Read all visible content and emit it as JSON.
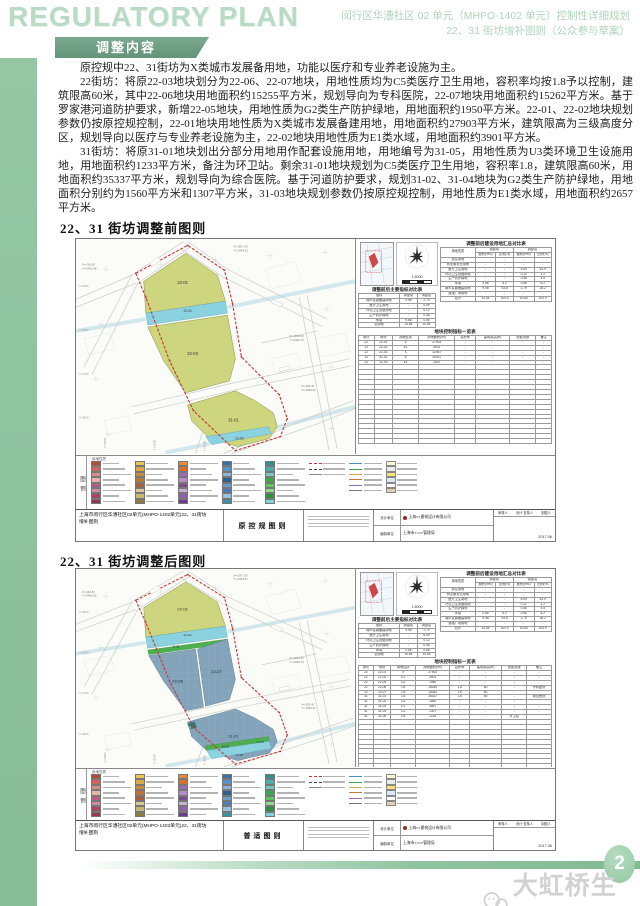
{
  "header": {
    "title_en": "REGULATORY PLAN",
    "doc_title_line1": "闵行区华漕社区 02 单元（MHPO-1402 单元）控制性详细规划",
    "doc_title_line2": "22、31 街坊增补图则（公众参与草案）",
    "section_banner": "调整内容"
  },
  "body": {
    "para1": "原控规中22、31街坊为X类城市发展备用地，功能以医疗和专业养老设施为主。",
    "para2": "22街坊：将原22-03地块划分为22-06、22-07地块，用地性质均为C5类医疗卫生用地，容积率均按1.8予以控制，建筑限高60米，其中22-06地块用地面积约15255平方米，规划导向为专科医院，22-07地块用地面积约15262平方米。基于罗家港河道防护要求，新增22-05地块，用地性质为G2类生产防护绿地，用地面积约1950平方米。22-01、22-02地块规划参数仍按原控规控制，22-01地块用地性质为X类城市发展备建用地，用地面积约27903平方米，建筑限高为三级高度分区，规划导向以医疗与专业养老设施为主，22-02地块用地性质为E1类水域，用地面积约3901平方米。",
    "para3": "31街坊：将原31-01地块划出分部分用地用作配套设施用地，用地编号为31-05，用地性质为U3类环境卫生设施用地，用地面积约1233平方米，备注为环卫站。剩余31-01地块规划为C5类医疗卫生用地，容积率1.8，建筑限高60米，用地面积约35337平方米，规划导向为综合医院。基于河道防护要求，规划31-02、31-04地块为G2类生产防护绿地，用地面积分别约为1560平方米和1307平方米，31-03地块规划参数仍按原控规控制，用地性质为E1类水域，用地面积约2657平方米。"
  },
  "sections": {
    "before_heading": "22、31 街坊调整前图则",
    "after_heading": "22、31 街坊调整后图则"
  },
  "maps": {
    "before": {
      "sheet_label": "原控规图则",
      "parcels": {
        "a": "22-01",
        "b": "22-02",
        "c": "22-03",
        "d": "31-01",
        "e": "31-03"
      }
    },
    "after": {
      "sheet_label": "普适图则",
      "parcels": {
        "a": "22-01",
        "b": "22-02",
        "c": "22-05",
        "d": "22-06",
        "e": "22-07",
        "f": "31-01",
        "g": "31-02",
        "h": "31-03",
        "i": "31-04",
        "j": "31-05"
      }
    }
  },
  "map_annotations": {
    "scale": "1:5000",
    "x_labels": [
      "X-2500",
      "X-2600",
      "X-2700",
      "X-2800"
    ],
    "y_labels": [
      "Y-15800",
      "Y-16000",
      "Y-16200"
    ],
    "callouts": [
      [
        "X=-263.50",
        "Y=-2462.68"
      ],
      [
        "X=-297.170",
        "Y=-2443.81"
      ],
      [
        "X=-1863.50",
        "Y=-2440.76"
      ],
      [
        "X=-392.45",
        "Y=-2366.42"
      ]
    ]
  },
  "legend": {
    "tab": "图例",
    "header": "用地性质",
    "colors": [
      "#b5493f",
      "#c9685c",
      "#d98d82",
      "#e7b3a9",
      "#b75a80",
      "#cf8aa6",
      "#a8455f",
      "#8f3a52",
      "#e8c94e",
      "#d9a944",
      "#c98c3c",
      "#b8763c",
      "#a86136",
      "#d9c992",
      "#c9b671",
      "#8f7a3e",
      "#e88a3c",
      "#d96e30",
      "#9b6cb5",
      "#b58cc9",
      "#7c4c8f",
      "#c9b0d9",
      "#8f61a8",
      "#6e3c8f",
      "#3c70a8",
      "#5c90c9",
      "#90b4d9",
      "#2f618f",
      "#6e9cc9",
      "#4c7cb5",
      "#9cc1e0",
      "#3c90a8",
      "#2f908a",
      "#4cada8",
      "#70c9c0",
      "#3ca84c",
      "#5cc95c",
      "#90d990",
      "#2f8f3c",
      "#85d1df"
    ],
    "boundary_lines": [
      "#cc3333",
      "#444444",
      "#888888"
    ],
    "line_samples": [
      "#4a90c2",
      "#3aa84a",
      "#d9a944",
      "#cc7a3a",
      "#9b6ab5",
      "#777777"
    ],
    "misc_boxes": [
      "#fdf6d8",
      "#ececec",
      "#f5e27a",
      "#dce8f5",
      "#ffffff",
      "#e0d0b8"
    ]
  },
  "tables": {
    "before": {
      "summary": {
        "title": "调整前后建设用地汇总对比表",
        "header": [
          [
            [
              "用地性质",
              1,
              2
            ],
            [
              "调整前",
              2,
              1
            ],
            [
              "调整后",
              2,
              1
            ]
          ],
          [
            [
              "面积(hm²)",
              1,
              1
            ],
            [
              "比例(%)",
              1,
              1
            ],
            [
              "面积(hm²)",
              1,
              1
            ],
            [
              "比例(%)",
              1,
              1
            ]
          ]
        ],
        "rows": [
          [
            "居住用地",
            "-",
            "-",
            "-",
            "-"
          ],
          [
            "商业服务业用地",
            "-",
            "-",
            "-",
            "-"
          ],
          [
            "医疗卫生用地",
            "-",
            "-",
            "6.59",
            "61.9"
          ],
          [
            "环境卫生设施用地",
            "-",
            "-",
            "0.12",
            "1.2"
          ],
          [
            "生产防护绿地",
            "-",
            "-",
            "0.48",
            "4.5"
          ],
          [
            "水域",
            "0.66",
            "6.2",
            "0.66",
            "6.2"
          ],
          [
            "城市发展备建用地",
            "9.98",
            "93.8",
            "2.79",
            "26.2"
          ],
          [
            "道路广场用地",
            "-",
            "-",
            "-",
            "-"
          ],
          [
            "合计",
            "10.64",
            "100.0",
            "10.64",
            "100.0"
          ]
        ],
        "empty_rows": 0
      },
      "indicator": {
        "title": "调整前后主要指标对比表",
        "header": [
          [
            [
              "指标",
              1,
              1
            ],
            [
              "调整前",
              1,
              1
            ],
            [
              "调整后",
              1,
              1
            ]
          ]
        ],
        "rows": [
          [
            "城市发展备建用地",
            "9.98",
            "2.79"
          ],
          [
            "医疗卫生用地",
            "-",
            "6.59"
          ],
          [
            "环境卫生设施用地",
            "-",
            "0.12"
          ],
          [
            "生产防护绿地",
            "-",
            "0.48"
          ],
          [
            "水域",
            "0.66",
            "0.66"
          ],
          [
            "总用地",
            "10.64",
            "10.64"
          ]
        ],
        "empty_rows": 0
      },
      "control": {
        "title": "地块控制指标一览表",
        "header": [
          [
            [
              "街坊",
              1,
              1
            ],
            [
              "地块",
              1,
              1
            ],
            [
              "用地性质",
              1,
              1
            ],
            [
              "用地面积(m²)",
              1,
              1
            ],
            [
              "容积率",
              1,
              1
            ],
            [
              "建筑限高(m)",
              1,
              1
            ],
            [
              "配套设施",
              1,
              1
            ],
            [
              "备注",
              1,
              1
            ]
          ]
        ],
        "rows": [
          [
            "22",
            "22-01",
            "X",
            "27903",
            "-",
            "-",
            "-",
            "-"
          ],
          [
            "22",
            "22-02",
            "E1",
            "3901",
            "-",
            "-",
            "-",
            "-"
          ],
          [
            "22",
            "22-03",
            "X",
            "32467",
            "-",
            "-",
            "-",
            "-"
          ],
          [
            "31",
            "31-01",
            "X",
            "39437",
            "-",
            "-",
            "-",
            "-"
          ],
          [
            "31",
            "31-03",
            "E1",
            "2657",
            "-",
            "-",
            "-",
            "-"
          ]
        ],
        "empty_rows": 16
      }
    },
    "after": {
      "summary": {
        "title": "调整前后建设用地汇总对比表",
        "header": [
          [
            [
              "用地性质",
              1,
              2
            ],
            [
              "调整前",
              2,
              1
            ],
            [
              "调整后",
              2,
              1
            ]
          ],
          [
            [
              "面积(hm²)",
              1,
              1
            ],
            [
              "比例(%)",
              1,
              1
            ],
            [
              "面积(hm²)",
              1,
              1
            ],
            [
              "比例(%)",
              1,
              1
            ]
          ]
        ],
        "rows": [
          [
            "居住用地",
            "-",
            "-",
            "-",
            "-"
          ],
          [
            "商业服务业用地",
            "-",
            "-",
            "-",
            "-"
          ],
          [
            "医疗卫生用地",
            "-",
            "-",
            "6.59",
            "61.9"
          ],
          [
            "环境卫生设施用地",
            "-",
            "-",
            "0.12",
            "1.2"
          ],
          [
            "生产防护绿地",
            "-",
            "-",
            "0.48",
            "4.5"
          ],
          [
            "水域",
            "0.66",
            "6.2",
            "0.66",
            "6.2"
          ],
          [
            "城市发展备建用地",
            "9.98",
            "93.8",
            "2.79",
            "26.2"
          ],
          [
            "道路广场用地",
            "-",
            "-",
            "-",
            "-"
          ],
          [
            "合计",
            "10.64",
            "100.0",
            "10.64",
            "100.0"
          ]
        ],
        "empty_rows": 0
      },
      "indicator": {
        "title": "调整前后主要指标对比表",
        "header": [
          [
            [
              "指标",
              1,
              1
            ],
            [
              "调整前",
              1,
              1
            ],
            [
              "调整后",
              1,
              1
            ]
          ]
        ],
        "rows": [
          [
            "城市发展备建用地",
            "9.98",
            "2.79"
          ],
          [
            "医疗卫生用地",
            "-",
            "6.59"
          ],
          [
            "环境卫生设施用地",
            "-",
            "0.12"
          ],
          [
            "生产防护绿地",
            "-",
            "0.48"
          ],
          [
            "水域",
            "0.66",
            "0.66"
          ],
          [
            "总用地",
            "10.64",
            "10.64"
          ]
        ],
        "empty_rows": 0
      },
      "control": {
        "title": "地块控制指标一览表",
        "header": [
          [
            [
              "街坊",
              1,
              1
            ],
            [
              "地块",
              1,
              1
            ],
            [
              "用地性质",
              1,
              1
            ],
            [
              "用地面积(m²)",
              1,
              1
            ],
            [
              "容积率",
              1,
              1
            ],
            [
              "建筑限高(m)",
              1,
              1
            ],
            [
              "配套设施",
              1,
              1
            ],
            [
              "备注",
              1,
              1
            ]
          ]
        ],
        "rows": [
          [
            "22",
            "22-01",
            "X",
            "27903",
            "-",
            "-",
            "-",
            "-"
          ],
          [
            "22",
            "22-02",
            "E1",
            "3901",
            "-",
            "-",
            "-",
            "-"
          ],
          [
            "22",
            "22-05",
            "G2",
            "1950",
            "-",
            "-",
            "-",
            "-"
          ],
          [
            "22",
            "22-06",
            "C5",
            "15255",
            "1.8",
            "60",
            "-",
            "专科医院"
          ],
          [
            "22",
            "22-07",
            "C5",
            "15262",
            "1.8",
            "60",
            "-",
            "-"
          ],
          [
            "31",
            "31-01",
            "C5",
            "35337",
            "1.8",
            "60",
            "-",
            "综合医院"
          ],
          [
            "31",
            "31-02",
            "G2",
            "1560",
            "-",
            "-",
            "-",
            "-"
          ],
          [
            "31",
            "31-03",
            "E1",
            "2657",
            "-",
            "-",
            "-",
            "-"
          ],
          [
            "31",
            "31-04",
            "G2",
            "1307",
            "-",
            "-",
            "-",
            "-"
          ],
          [
            "31",
            "31-05",
            "U3",
            "1233",
            "-",
            "-",
            "环卫站",
            "-"
          ]
        ],
        "empty_rows": 10
      }
    }
  },
  "titlebar": {
    "project_line1": "上海市闵行区华漕社区02单元(MHPO-1402单元)22、31街坊",
    "project_line2": "增补图则",
    "design_unit_label": "设计单位",
    "compile_unit_label": "编制单位",
    "design_unit": "上海××建筑设计有限公司",
    "compile_unit": "上海市××××管理局",
    "reviewer_label": "审核人",
    "checker_label": "设计·复核人",
    "drafter_label": "制图人",
    "date": "2017.06"
  },
  "footer": {
    "page_number": "2",
    "watermark": "大虹桥生活网"
  }
}
